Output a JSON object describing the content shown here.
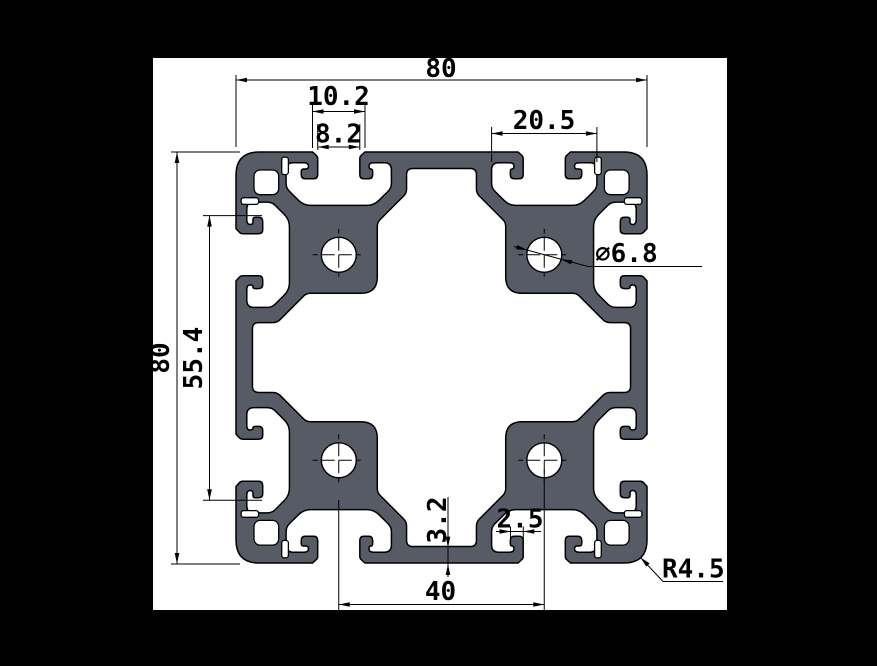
{
  "drawing": {
    "type": "technical-drawing",
    "subject": "80x80 aluminium T-slot extrusion profile cross-section",
    "colors": {
      "background": "#000000",
      "paper": "#ffffff",
      "profile_fill": "#565b66",
      "line": "#000000"
    },
    "dimensions": [
      {
        "id": "overall-width",
        "label": "80"
      },
      {
        "id": "slot-counterbore",
        "label": "10.2"
      },
      {
        "id": "slot-opening",
        "label": "8.2"
      },
      {
        "id": "slot-cavity-width",
        "label": "20.5"
      },
      {
        "id": "overall-height",
        "label": "80"
      },
      {
        "id": "inner-span",
        "label": "55.4"
      },
      {
        "id": "hole-diameter",
        "label": "∅6.8"
      },
      {
        "id": "wall-thickness",
        "label": "3.2"
      },
      {
        "id": "lip-foot",
        "label": "2.5"
      },
      {
        "id": "hole-spacing",
        "label": "40"
      },
      {
        "id": "corner-radius",
        "label": "R4.5"
      }
    ]
  }
}
